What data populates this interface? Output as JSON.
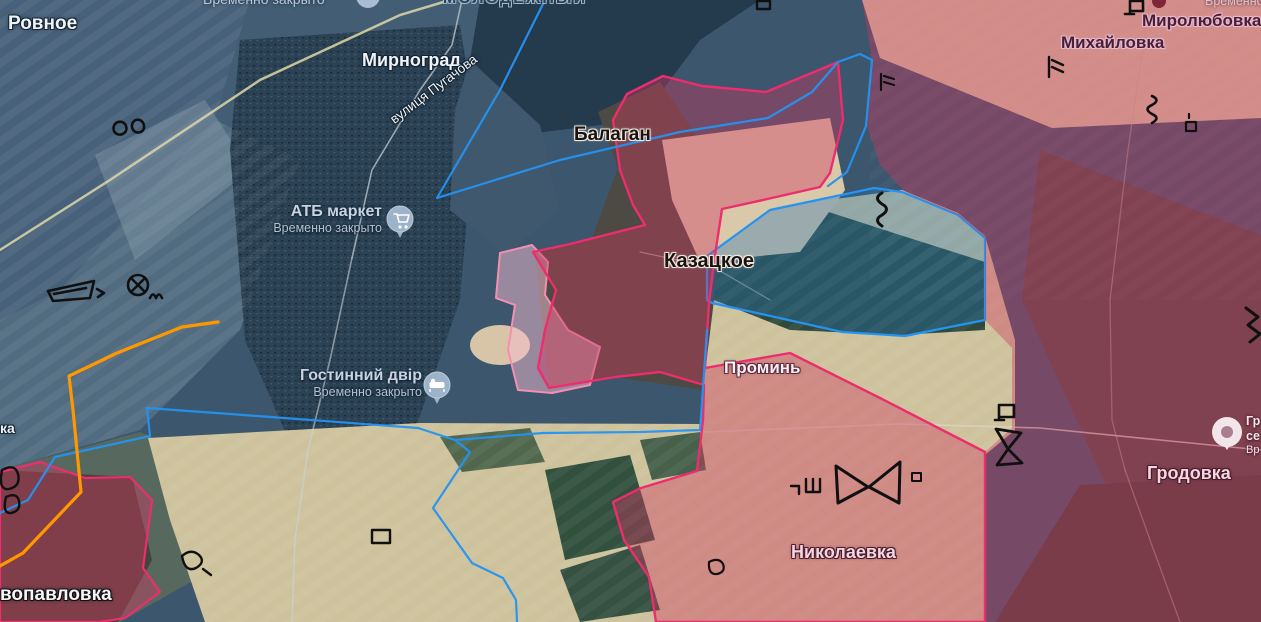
{
  "map": {
    "labels": {
      "rovnoe": "Ровное",
      "molodezhny": "МОЛОДЕЖНЫЙ",
      "mirnograd": "Мирноград",
      "pugachova": "вулиця Пугачова",
      "balagan": "Балаган",
      "kazatskoe": "Казацкое",
      "promin": "Проминь",
      "nikolaevka": "Николаевка",
      "grodovka": "Гродовка",
      "mikhailovka": "Михайловка",
      "mirolyubovka": "Миролюбовка",
      "vopavlovka": "вопавловка",
      "ka_partial": "ка",
      "vremenno_top": "Временно закрыто",
      "vremenno_top_right": "Временно за"
    },
    "pois": {
      "atb": {
        "title": "АТБ маркет",
        "status": "Временно закрыто",
        "icon": "shopping-cart"
      },
      "hostel": {
        "title": "Гостинний двір",
        "status": "Временно закрыто",
        "icon": "bed"
      },
      "grodovka_poi": {
        "line1": "Гр",
        "line2": "се",
        "line3": "Вр",
        "icon": "place"
      }
    },
    "zones": {
      "occupied_fill": "#d03b5f",
      "occupied_border": "#ed2d6d",
      "claimed_fill": "#f6bcd0",
      "claimed_border": "#f48fb1",
      "unit_boundary_blue": "#2493f2",
      "frontline_orange": "#ff9800",
      "fortification_black": "#101010"
    }
  }
}
